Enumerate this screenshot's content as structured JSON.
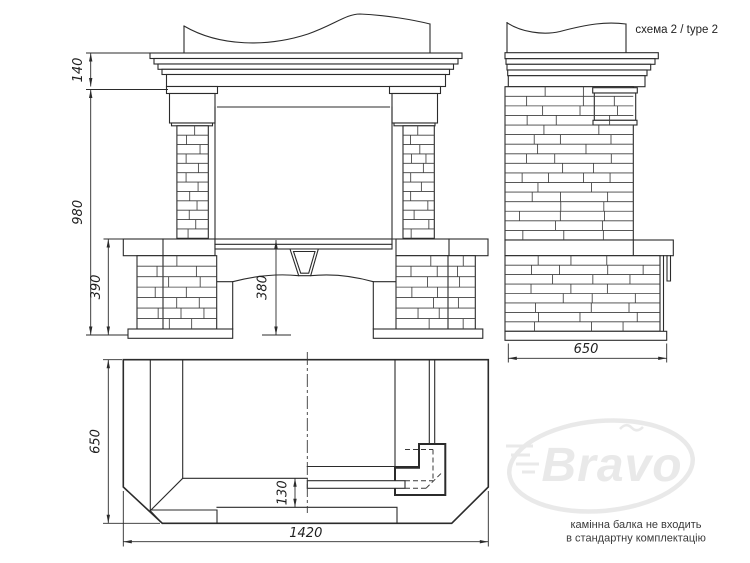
{
  "labels": {
    "scheme": "схема 2 / type 2"
  },
  "note": {
    "line1": "камінна балка не входить",
    "line2": "в стандартну комплектацію"
  },
  "watermark": {
    "text": "Bravo"
  },
  "dims": {
    "front_cornice_height": "140",
    "front_total_height": "980",
    "front_base_height": "390",
    "front_opening_height": "380",
    "side_depth": "650",
    "plan_depth": "650",
    "plan_width": "1420",
    "plan_hearth_lip": "130"
  },
  "colors": {
    "background": "#ffffff",
    "line": "#2b2b2b",
    "note_text": "#3a3a3a",
    "watermark": "#e9e9e9"
  }
}
